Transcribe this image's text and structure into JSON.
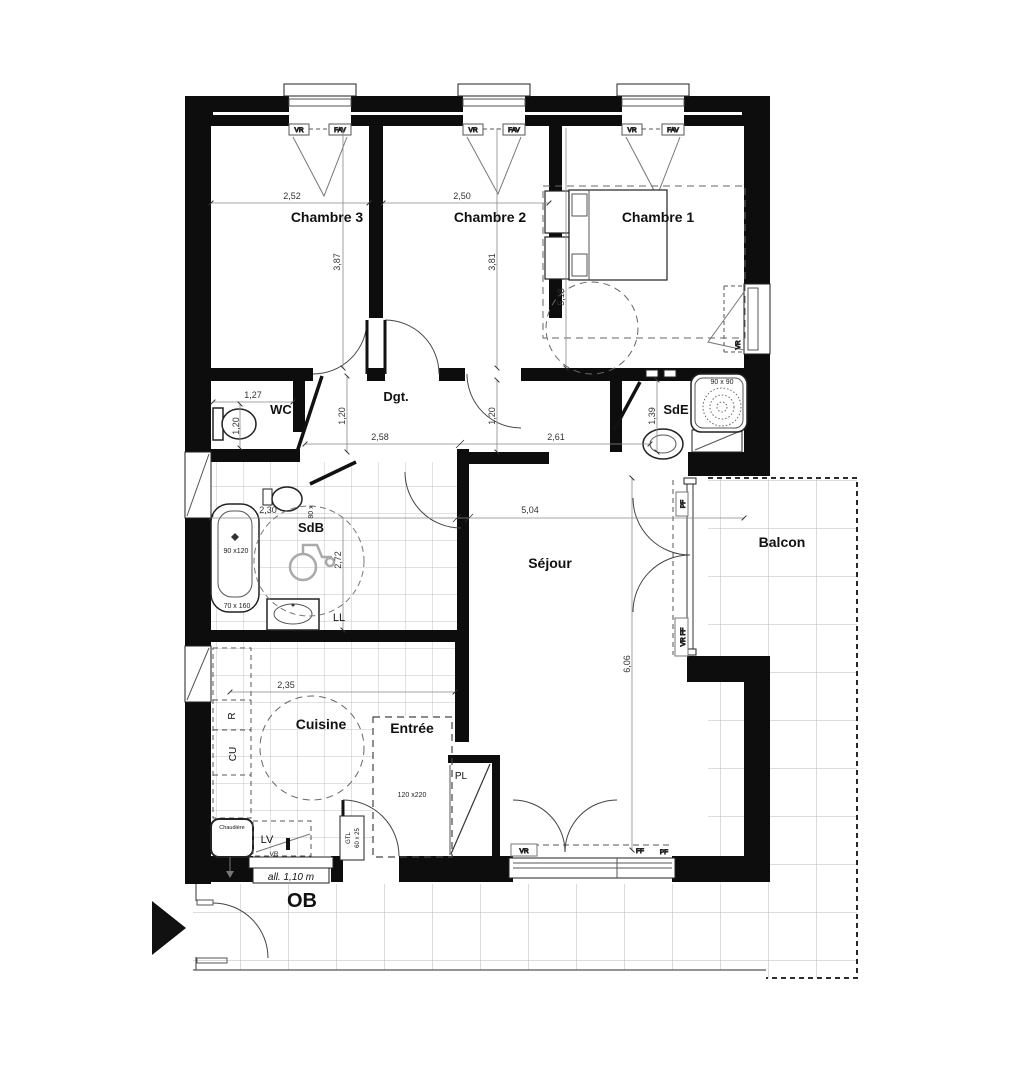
{
  "colors": {
    "wall": "#0d0d0d",
    "line": "#444444",
    "tile": "#b8b8b8",
    "dash": "#555555"
  },
  "rooms": {
    "chambre_3": "Chambre 3",
    "chambre_2": "Chambre 2",
    "chambre_1": "Chambre 1",
    "wc": "WC",
    "degagement": "Dgt.",
    "salle_eau": "SdE",
    "salle_bains": "SdB",
    "sejour": "Séjour",
    "balcon": "Balcon",
    "cuisine": "Cuisine",
    "entree": "Entrée"
  },
  "dimensions": {
    "chambre3_width": "2,52",
    "chambre3_depth": "3,87",
    "chambre2_width": "2,50",
    "chambre2_depth": "3,81",
    "chambre1_depth": "5,18",
    "wc_width": "1,27",
    "wc_depth": "1,20",
    "dgt_height_left": "1,20",
    "dgt_height_right": "1,20",
    "dgt_width": "2,58",
    "couloir_width": "2,61",
    "sde_depth": "1,39",
    "sdb_width": "2,30",
    "sdb_depth": "2,72",
    "sejour_width": "5,04",
    "sejour_depth": "6,06",
    "cuisine_width": "2,35"
  },
  "equipment": {
    "baignoire_size": "90 x120",
    "baignoire_size_2": "70 x 160",
    "douche_size": "90 x 90",
    "porte_entree_size": "120 x220",
    "meuble_size": "80 x",
    "lave_linge": "LL",
    "placard": "PL",
    "lave_vaisselle": "LV",
    "refrigerateur": "R",
    "cuisson": "CU",
    "chaudiere": "Chaudière",
    "gtl_line1": "GTL",
    "gtl_line2": "60 x 25"
  },
  "window_labels": {
    "vr": "VR",
    "fav": "FAV",
    "ff": "FF",
    "pf": "PF",
    "vr_ff": "VR FF"
  },
  "annotations": {
    "allege": "all. 1,10 m",
    "ob": "OB"
  }
}
